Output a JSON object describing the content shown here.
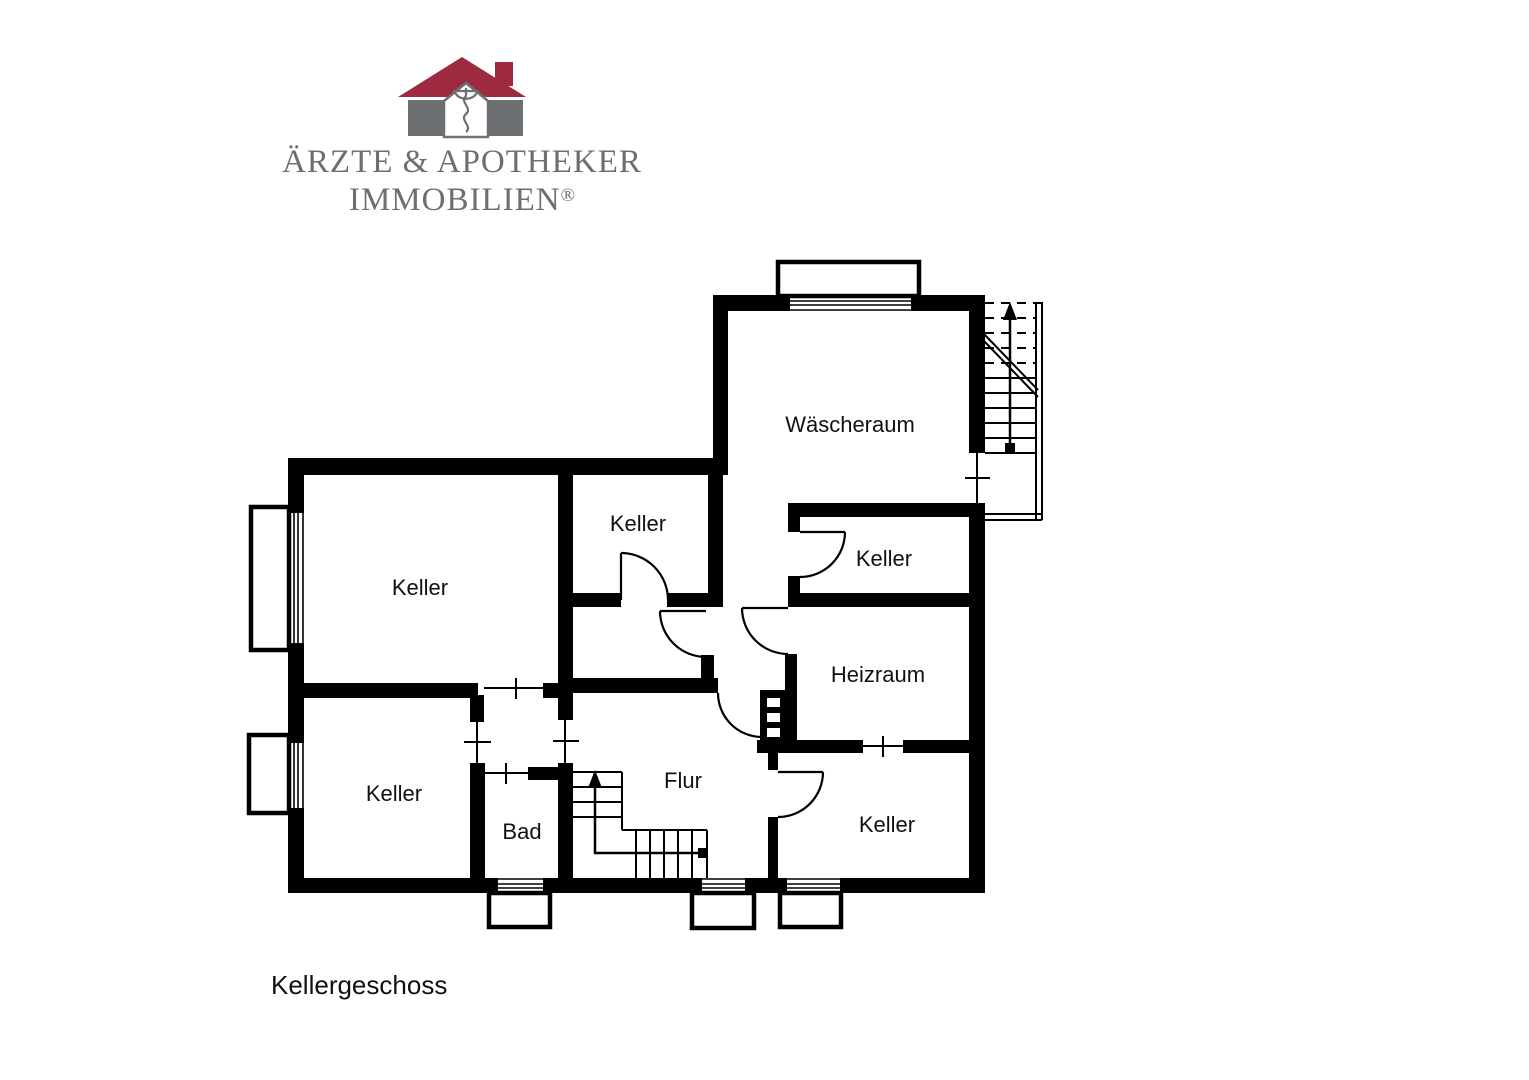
{
  "logo": {
    "company_line1": "ÄRZTE & APOTHEKER",
    "company_line2": "IMMOBILIEN",
    "registered_mark": "®",
    "colors": {
      "roof": "#9e2a3f",
      "gray": "#6c7072"
    }
  },
  "plan": {
    "title": "Kellergeschoss",
    "rooms": {
      "wascheraum": "Wäscheraum",
      "keller_top": "Keller",
      "keller_right": "Keller",
      "keller_large": "Keller",
      "heizraum": "Heizraum",
      "keller_bottom_left": "Keller",
      "bad": "Bad",
      "flur": "Flur",
      "keller_bottom_right": "Keller"
    }
  }
}
